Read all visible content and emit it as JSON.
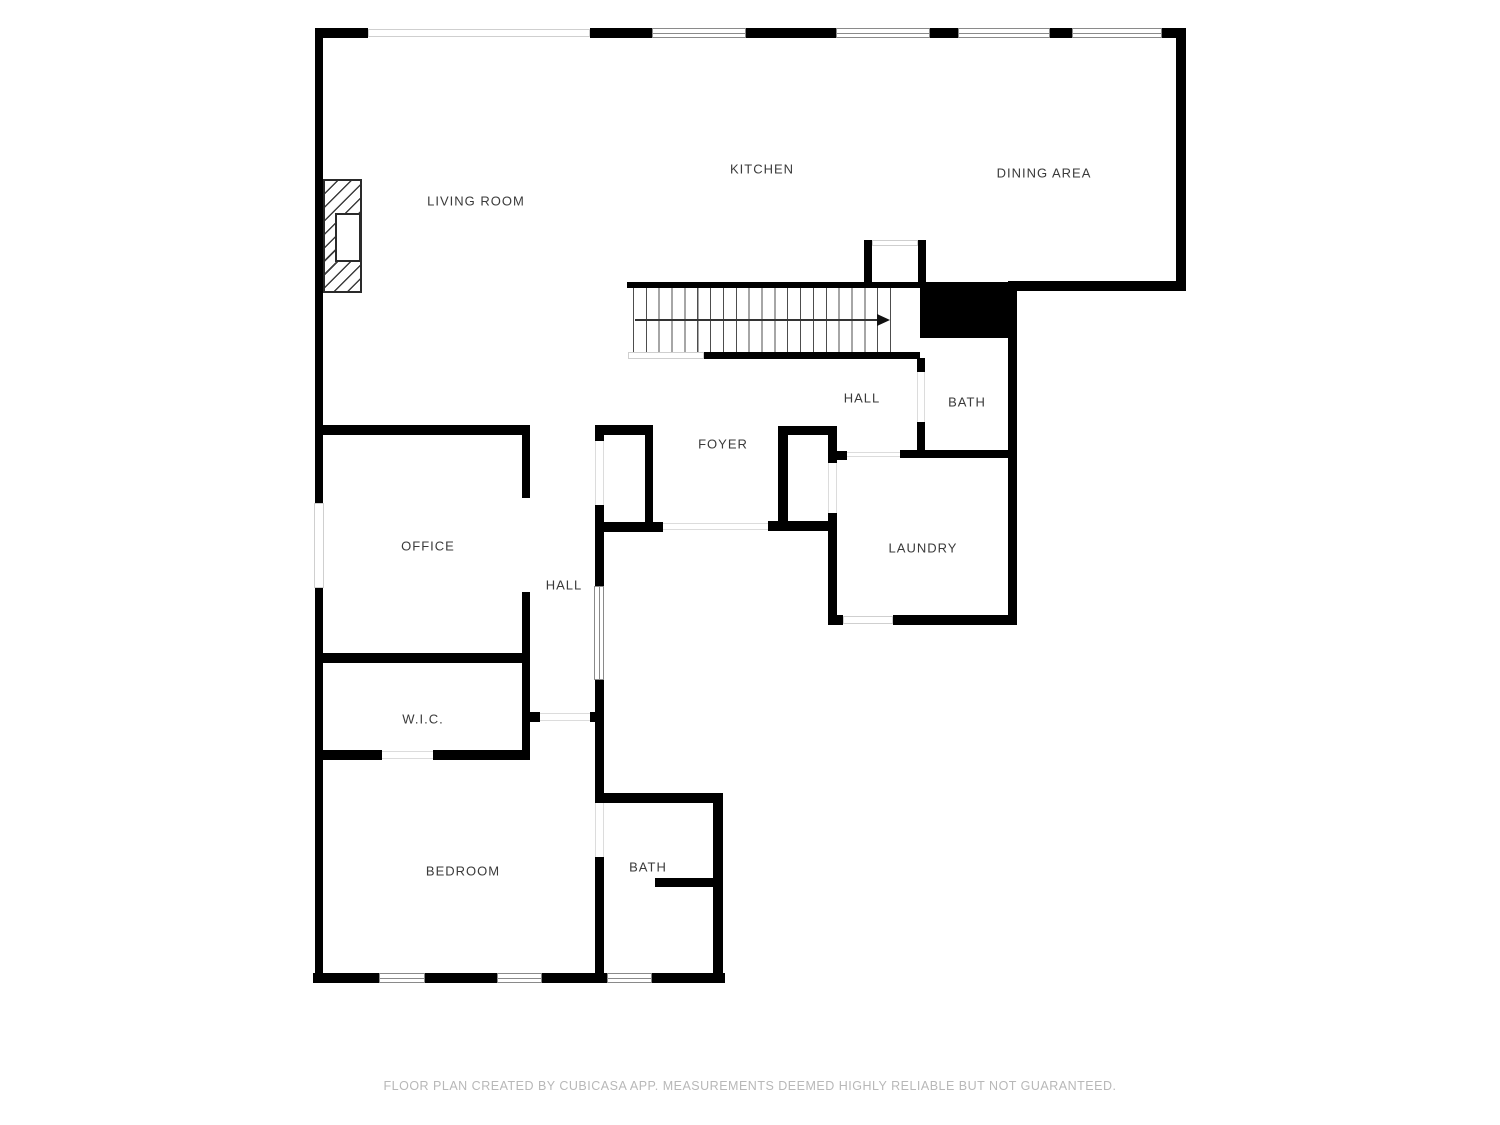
{
  "rooms": {
    "living_room": {
      "label": "LIVING ROOM"
    },
    "kitchen": {
      "label": "KITCHEN"
    },
    "dining_area": {
      "label": "DINING AREA"
    },
    "hall_upper": {
      "label": "HALL"
    },
    "bath_upper": {
      "label": "BATH"
    },
    "foyer": {
      "label": "FOYER"
    },
    "laundry": {
      "label": "LAUNDRY"
    },
    "office": {
      "label": "OFFICE"
    },
    "hall_lower": {
      "label": "HALL"
    },
    "wic": {
      "label": "W.I.C."
    },
    "bedroom": {
      "label": "BEDROOM"
    },
    "bath_lower": {
      "label": "BATH"
    }
  },
  "stairs": {
    "direction_arrow": "right",
    "tread_count": 20
  },
  "footer": {
    "text": "FLOOR PLAN CREATED BY CUBICASA APP. MEASUREMENTS DEEMED HIGHLY RELIABLE BUT NOT GUARANTEED."
  },
  "colors": {
    "wall": "#000000",
    "label": "#3a3a3a",
    "footer_text": "#b8b8b8",
    "window_frame": "#8a8a8a"
  }
}
